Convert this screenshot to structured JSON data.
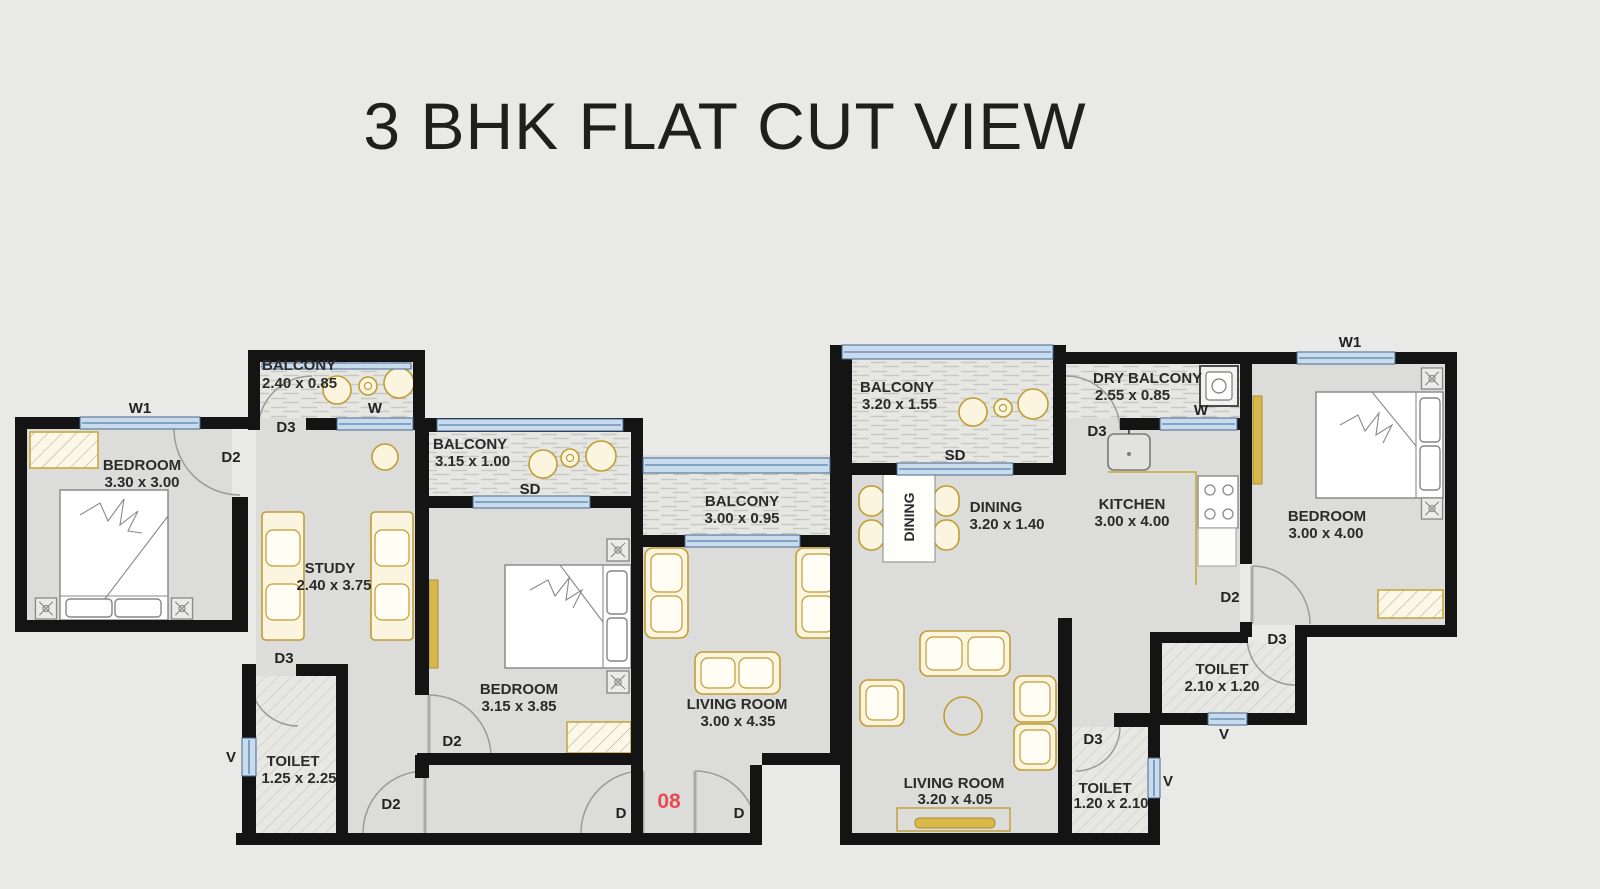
{
  "title": "3 BHK FLAT CUT VIEW",
  "colors": {
    "background": "#e9e9e7",
    "floor": "#dcdcda",
    "wall": "#141414",
    "window_fill": "#c9dcee",
    "window_line": "#48688c",
    "furniture_gold": "#c19d33",
    "furniture_fill": "#fbf5df",
    "unit_number_red": "#e84b52",
    "text": "#2b2b2b"
  },
  "rooms": [
    {
      "id": "bedroom-left",
      "label": "BEDROOM",
      "dims": "3.30 x 3.00"
    },
    {
      "id": "study",
      "label": "STUDY",
      "dims": "2.40 x 3.75"
    },
    {
      "id": "balcony-study",
      "label": "BALCONY",
      "dims": "2.40 x 0.85"
    },
    {
      "id": "toilet-left",
      "label": "TOILET",
      "dims": "1.25 x 2.25"
    },
    {
      "id": "bedroom-middle",
      "label": "BEDROOM",
      "dims": "3.15 x 3.85"
    },
    {
      "id": "balcony-middle",
      "label": "BALCONY",
      "dims": "3.15 x 1.00"
    },
    {
      "id": "living-room-left",
      "label": "LIVING ROOM",
      "dims": "3.00 x 4.35"
    },
    {
      "id": "balcony-living",
      "label": "BALCONY",
      "dims": "3.00 x 0.95"
    },
    {
      "id": "balcony-dining",
      "label": "BALCONY",
      "dims": "3.20 x 1.55"
    },
    {
      "id": "dry-balcony",
      "label": "DRY BALCONY",
      "dims": "2.55 x 0.85"
    },
    {
      "id": "dining",
      "label": "DINING",
      "dims": "3.20 x 1.40"
    },
    {
      "id": "kitchen",
      "label": "KITCHEN",
      "dims": "3.00 x 4.00"
    },
    {
      "id": "bedroom-right",
      "label": "BEDROOM",
      "dims": "3.00 x 4.00"
    },
    {
      "id": "toilet-upper-right",
      "label": "TOILET",
      "dims": "2.10 x 1.20"
    },
    {
      "id": "toilet-lower-right",
      "label": "TOILET",
      "dims": "1.20 x 2.10"
    },
    {
      "id": "living-room-right",
      "label": "LIVING ROOM",
      "dims": "3.20 x 4.05"
    }
  ],
  "markers": [
    {
      "id": "w1-left",
      "text": "W1"
    },
    {
      "id": "d2-bedroom-left",
      "text": "D2"
    },
    {
      "id": "d3-balcony-study",
      "text": "D3"
    },
    {
      "id": "w-study",
      "text": "W"
    },
    {
      "id": "d3-toilet-left",
      "text": "D3"
    },
    {
      "id": "v-toilet-left",
      "text": "V"
    },
    {
      "id": "d2-corridor",
      "text": "D2"
    },
    {
      "id": "d2-bedroom-mid",
      "text": "D2"
    },
    {
      "id": "sd-bedroom-mid",
      "text": "SD"
    },
    {
      "id": "d-entry-left",
      "text": "D"
    },
    {
      "id": "unit-number",
      "text": "08"
    },
    {
      "id": "d-entry-right",
      "text": "D"
    },
    {
      "id": "sd-dining",
      "text": "SD"
    },
    {
      "id": "d3-dry-balcony",
      "text": "D3"
    },
    {
      "id": "w-dry-balcony",
      "text": "W"
    },
    {
      "id": "w1-right",
      "text": "W1"
    },
    {
      "id": "d2-bedroom-right",
      "text": "D2"
    },
    {
      "id": "d3-toilet-upper",
      "text": "D3"
    },
    {
      "id": "v-toilet-upper",
      "text": "V"
    },
    {
      "id": "d3-toilet-lower",
      "text": "D3"
    },
    {
      "id": "v-toilet-lower",
      "text": "V"
    },
    {
      "id": "dining-table",
      "text": "DINING"
    }
  ]
}
